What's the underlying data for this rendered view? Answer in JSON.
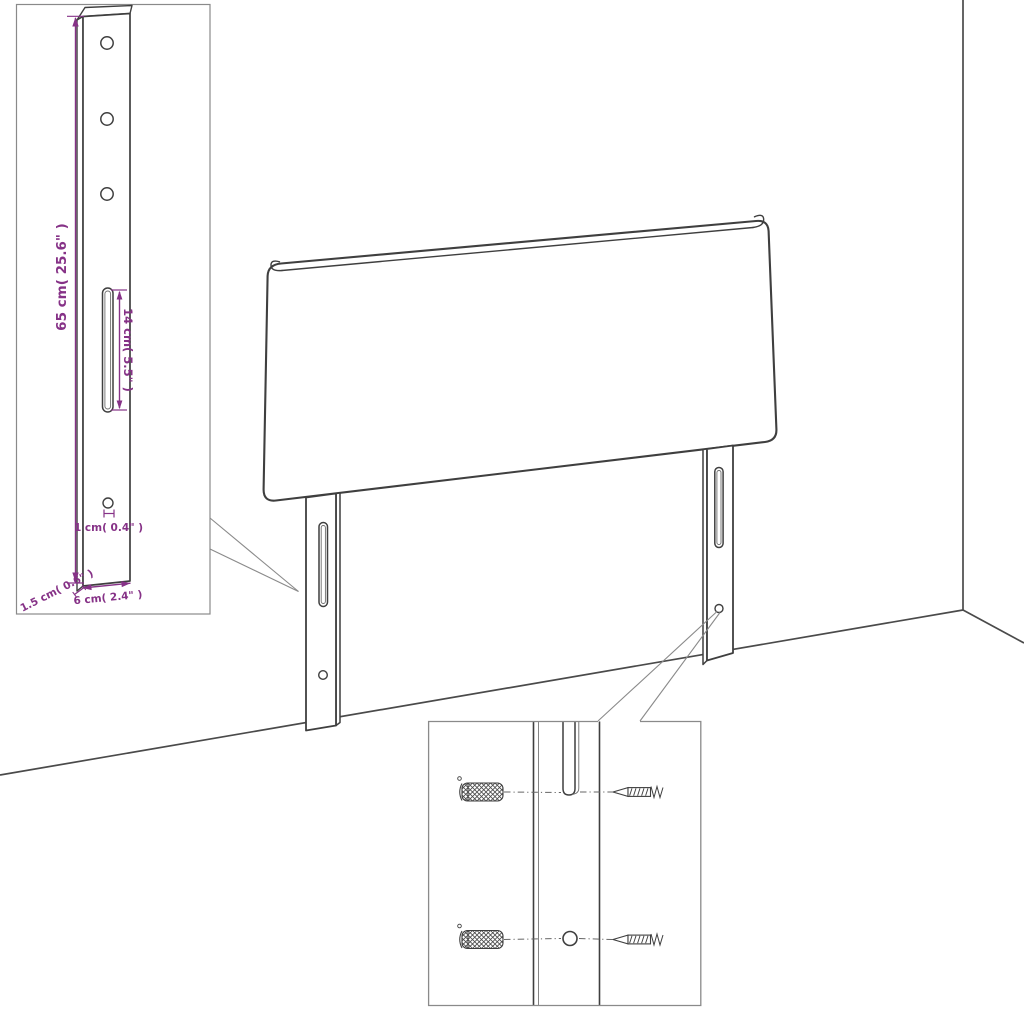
{
  "page": {
    "background": "#ffffff",
    "width": 1024,
    "height": 1024
  },
  "diagram": {
    "type": "furniture-dimension-line-drawing",
    "subject": "headboard with two mounting legs shown against a room corner, with a leg dimension inset and a wall-anchor/screw hardware inset",
    "colors": {
      "line_art": "#3f3f3f",
      "inset_border": "#8a8a8a",
      "dimension_accent": "#863287",
      "background": "#ffffff"
    },
    "leg_detail": {
      "labels": {
        "height": "65 cm( 25.6\" )",
        "slot_length": "14 cm( 5.5\" )",
        "hole": "1 cm( 0.4\" )",
        "depth": "1.5 cm( 0.6\" )",
        "width": "6 cm( 2.4\" )"
      },
      "hole_count": 4,
      "slot_count": 1
    },
    "hardware_detail": {
      "wall_anchors": 2,
      "screws": 2
    }
  }
}
